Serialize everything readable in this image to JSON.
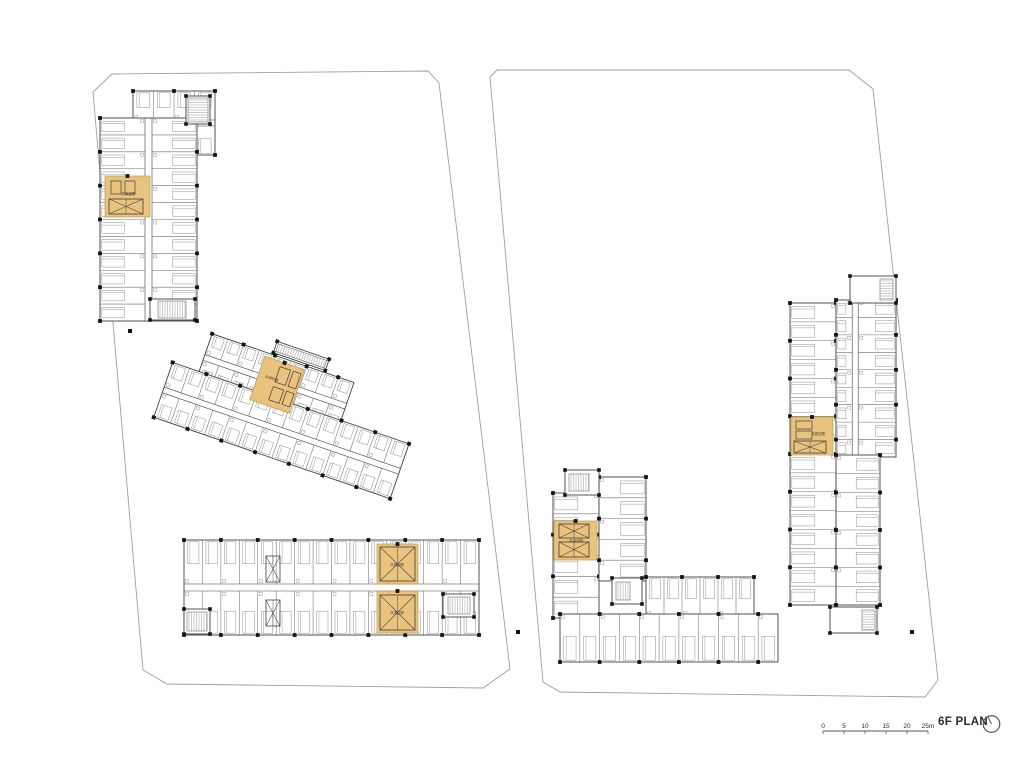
{
  "meta": {
    "title": "6F PLAN"
  },
  "colors": {
    "highlight": "#e9c37d",
    "highlight_edge": "#c09a52",
    "wall": "#3f3f3f",
    "partition": "#6f6f6f",
    "furniture": "#8f8f8f",
    "boundary": "#9f9f9f",
    "column": "#141414",
    "text": "#2b2b2b"
  },
  "scalebar": {
    "x": 823,
    "y": 731,
    "length": 105,
    "tick_labels": [
      "0",
      "5",
      "10",
      "15",
      "20",
      "25m"
    ]
  },
  "north": {
    "cx": 13.5,
    "cy": 14,
    "r": 8.3
  },
  "core_label": "共用空間",
  "plan": {
    "parcels": [
      {
        "points": "93,92 112,74 428,71 439,83 510,669 483,688 167,684 143,670"
      },
      {
        "points": "490,77 497,70 849,70 873,89 938,680 925,697 560,692 543,682"
      }
    ],
    "wings": [
      {
        "x": 133,
        "y": 91,
        "w": 82,
        "h": 64,
        "dir": "h",
        "bands": 2,
        "roomW": 20,
        "corr": 6
      },
      {
        "x": 100,
        "y": 118,
        "w": 97,
        "h": 203,
        "dir": "v",
        "bands": 2,
        "roomW": 17,
        "corr": 7
      },
      {
        "x": 191,
        "y": 360,
        "w": 150,
        "h": 50,
        "dir": "h",
        "bands": 2,
        "roomW": 17,
        "corr": 6,
        "rot": 19,
        "px": 280,
        "py": 410
      },
      {
        "x": 163,
        "y": 400,
        "w": 250,
        "h": 58,
        "dir": "h",
        "bands": 2,
        "roomW": 18,
        "corr": 6,
        "rot": 19,
        "px": 280,
        "py": 410
      },
      {
        "x": 184,
        "y": 540,
        "w": 295,
        "h": 95,
        "dir": "h",
        "bands": 2,
        "roomW": 18,
        "corr": 7
      },
      {
        "x": 790,
        "y": 303,
        "w": 46,
        "h": 302,
        "dir": "v",
        "bands": 1,
        "roomW": 19,
        "furn": "start"
      },
      {
        "x": 836,
        "y": 300,
        "w": 60,
        "h": 157,
        "dir": "v",
        "bands": 2,
        "roomW": 17,
        "corr": 6,
        "asym": 0.3
      },
      {
        "x": 836,
        "y": 455,
        "w": 44,
        "h": 150,
        "dir": "v",
        "bands": 1,
        "roomW": 19,
        "furn": "end"
      },
      {
        "x": 553,
        "y": 493,
        "w": 46,
        "h": 125,
        "dir": "v",
        "bands": 1,
        "roomW": 20,
        "furn": "start"
      },
      {
        "x": 599,
        "y": 477,
        "w": 47,
        "h": 104,
        "dir": "v",
        "bands": 1,
        "roomW": 19,
        "furn": "end"
      },
      {
        "x": 646,
        "y": 577,
        "w": 108,
        "h": 39,
        "dir": "h",
        "bands": 1,
        "roomW": 19,
        "furn": "start"
      },
      {
        "x": 560,
        "y": 614,
        "w": 218,
        "h": 48,
        "dir": "h",
        "bands": 1,
        "roomW": 19,
        "furn": "end"
      }
    ],
    "blocks": [
      {
        "x": 565,
        "y": 470,
        "w": 34,
        "h": 25,
        "hx": 569,
        "hy": 474,
        "hw": 20,
        "hh": 17,
        "hdir": "v"
      },
      {
        "x": 850,
        "y": 276,
        "w": 46,
        "h": 27,
        "hx": 880,
        "hy": 279,
        "hw": 13,
        "hh": 21,
        "hdir": "h"
      },
      {
        "x": 830,
        "y": 607,
        "w": 47,
        "h": 26,
        "hx": 862,
        "hy": 610,
        "hw": 13,
        "hh": 20,
        "hdir": "h"
      },
      {
        "x": 150,
        "y": 299,
        "w": 45,
        "h": 21,
        "hx": 158,
        "hy": 301,
        "hw": 28,
        "hh": 17,
        "hdir": "v"
      },
      {
        "x": 184,
        "y": 609,
        "w": 26,
        "h": 25,
        "hx": 187,
        "hy": 612,
        "hw": 20,
        "hh": 19,
        "hdir": "v"
      },
      {
        "x": 443,
        "y": 594,
        "w": 31,
        "h": 23,
        "hx": 448,
        "hy": 597,
        "hw": 22,
        "hh": 17,
        "hdir": "v"
      },
      {
        "x": 612,
        "y": 578,
        "w": 30,
        "h": 26,
        "hx": 616,
        "hy": 582,
        "hw": 14,
        "hh": 18,
        "hdir": "v"
      },
      {
        "x": 186,
        "y": 96,
        "w": 24,
        "h": 28,
        "hx": 188,
        "hy": 98,
        "hw": 20,
        "hh": 24,
        "hdir": "h"
      },
      {
        "x": 255,
        "y": 346,
        "w": 55,
        "h": 12,
        "hx": 257,
        "hy": 348,
        "hw": 51,
        "hh": 8,
        "hdir": "v",
        "rot": 19,
        "px": 280,
        "py": 410
      }
    ],
    "shafts": [
      {
        "x": 266,
        "y": 556,
        "w": 14,
        "h": 26
      },
      {
        "x": 266,
        "y": 600,
        "w": 14,
        "h": 26
      }
    ],
    "cores": [
      {
        "x": 105,
        "y": 176,
        "w": 45,
        "h": 41,
        "lx": 128,
        "ly": 195,
        "parts": [
          {
            "t": "rect",
            "x": 111,
            "y": 181,
            "w": 10,
            "h": 13
          },
          {
            "t": "rect",
            "x": 125,
            "y": 181,
            "w": 10,
            "h": 13
          },
          {
            "t": "xbox",
            "x": 109,
            "y": 199,
            "w": 34,
            "h": 15
          }
        ]
      },
      {
        "x": 248,
        "y": 364,
        "w": 42,
        "h": 46,
        "lx": 262,
        "ly": 384,
        "rot": 19,
        "px": 280,
        "py": 410,
        "parts": [
          {
            "t": "rect",
            "x": 266,
            "y": 369,
            "w": 11,
            "h": 16
          },
          {
            "t": "rect",
            "x": 280,
            "y": 369,
            "w": 8,
            "h": 16
          },
          {
            "t": "rect",
            "x": 266,
            "y": 390,
            "w": 11,
            "h": 14
          },
          {
            "t": "rect",
            "x": 280,
            "y": 390,
            "w": 8,
            "h": 14
          }
        ]
      },
      {
        "x": 377,
        "y": 544,
        "w": 41,
        "h": 40,
        "lx": 397,
        "ly": 566,
        "parts": [
          {
            "t": "xbox",
            "x": 380,
            "y": 547,
            "w": 35,
            "h": 34
          }
        ]
      },
      {
        "x": 377,
        "y": 591,
        "w": 41,
        "h": 42,
        "lx": 397,
        "ly": 614,
        "parts": [
          {
            "t": "xbox",
            "x": 380,
            "y": 595,
            "w": 35,
            "h": 35
          }
        ]
      },
      {
        "x": 791,
        "y": 417,
        "w": 42,
        "h": 38,
        "lx": 818,
        "ly": 435,
        "parts": [
          {
            "t": "rect",
            "x": 796,
            "y": 421,
            "w": 16,
            "h": 8
          },
          {
            "t": "rect",
            "x": 796,
            "y": 431,
            "w": 16,
            "h": 8
          },
          {
            "t": "xbox",
            "x": 794,
            "y": 441,
            "w": 32,
            "h": 12
          }
        ]
      },
      {
        "x": 554,
        "y": 521,
        "w": 43,
        "h": 39,
        "lx": 576,
        "ly": 542,
        "parts": [
          {
            "t": "xbox",
            "x": 559,
            "y": 524,
            "w": 30,
            "h": 14
          },
          {
            "t": "xbox",
            "x": 559,
            "y": 542,
            "w": 30,
            "h": 15
          }
        ]
      }
    ],
    "dots": [
      [
        130,
        331
      ],
      [
        518,
        632
      ],
      [
        912,
        632
      ]
    ]
  }
}
